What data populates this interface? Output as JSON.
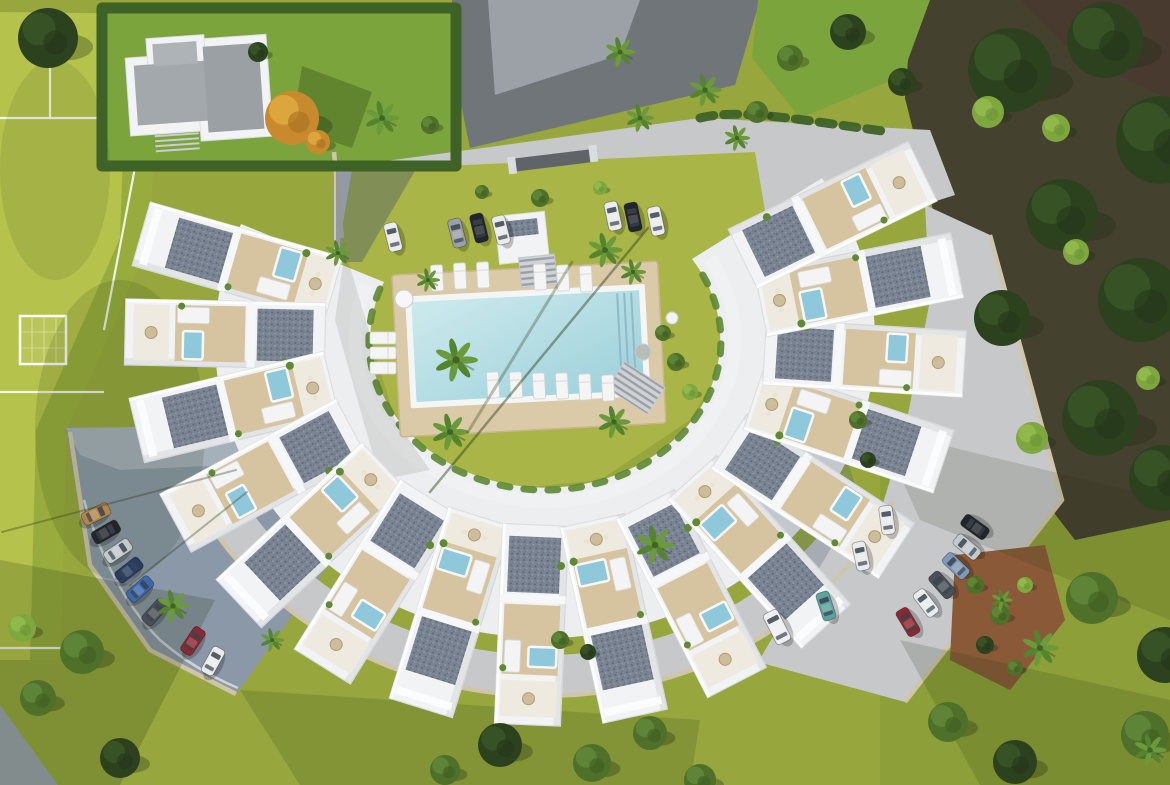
{
  "palette": {
    "grass": "#97a73e",
    "field": "#b5c24c",
    "fieldDark": "#93a83c",
    "lawnBright": "#7ba43c",
    "lawnCourt": "#a9b547",
    "hedge": "#3f6226",
    "road": "#70757a",
    "roadLight": "#9ba1a7",
    "pave": "#c6c8ca",
    "lot": "#8b98a8",
    "lotLight": "#a9b2bc",
    "building": "#f2f3f5",
    "buildingEdge": "#dcdfe2",
    "deck": "#d6c4a1",
    "poolDeck": "#dbcaa8",
    "poolRim": "#f4f6f6",
    "water1": "#cdeaed",
    "water2": "#9cd0da",
    "jacuzzi": "#8ec8da",
    "wall": "#cfc5ad",
    "soil": "#8a5a38",
    "roofGray": "#a3a8ac",
    "forest": "#45412f",
    "forestBrown": "#4a3a30",
    "olive": "#8d9f38",
    "paveShade": "#46566b"
  },
  "scene": {
    "buildings": {
      "cx": 545,
      "cy": 340,
      "rx": 320,
      "ry": 285,
      "len": 200,
      "wid": 66,
      "angles": [
        196,
        181.2,
        166.4,
        151.6,
        136.8,
        122,
        107.2,
        92.4,
        77.6,
        62.8,
        48,
        33.2,
        18.4,
        3.6,
        -11.2,
        -26
      ]
    },
    "cars": [
      {
        "x": 393,
        "y": 237,
        "rot": -14,
        "c": "#e9ebed"
      },
      {
        "x": 457,
        "y": 233,
        "rot": -14,
        "c": "#9aa1a8"
      },
      {
        "x": 479,
        "y": 228,
        "rot": -14,
        "c": "#22262b"
      },
      {
        "x": 501,
        "y": 230,
        "rot": -14,
        "c": "#e9ebed"
      },
      {
        "x": 613,
        "y": 216,
        "rot": -12,
        "c": "#e9ebed"
      },
      {
        "x": 633,
        "y": 217,
        "rot": -12,
        "c": "#22262b"
      },
      {
        "x": 656,
        "y": 221,
        "rot": -12,
        "c": "#e9ebed"
      },
      {
        "x": 96,
        "y": 514,
        "rot": 64,
        "c": "#b3854c"
      },
      {
        "x": 106,
        "y": 532,
        "rot": 60,
        "c": "#22262b"
      },
      {
        "x": 118,
        "y": 551,
        "rot": 56,
        "c": "#c4c9ce"
      },
      {
        "x": 129,
        "y": 570,
        "rot": 52,
        "c": "#273c63"
      },
      {
        "x": 140,
        "y": 589,
        "rot": 48,
        "c": "#3c69ac"
      },
      {
        "x": 155,
        "y": 612,
        "rot": 42,
        "c": "#4a5058"
      },
      {
        "x": 193,
        "y": 641,
        "rot": 34,
        "c": "#8d2731"
      },
      {
        "x": 213,
        "y": 661,
        "rot": 29,
        "c": "#e9ebed"
      },
      {
        "x": 975,
        "y": 527,
        "rot": -54,
        "c": "#22262b"
      },
      {
        "x": 967,
        "y": 547,
        "rot": -50,
        "c": "#c4c9ce"
      },
      {
        "x": 956,
        "y": 566,
        "rot": -46,
        "c": "#7f99b8"
      },
      {
        "x": 942,
        "y": 585,
        "rot": -42,
        "c": "#4a5058"
      },
      {
        "x": 926,
        "y": 603,
        "rot": -37,
        "c": "#e9ebed"
      },
      {
        "x": 908,
        "y": 622,
        "rot": -31,
        "c": "#8d2731"
      },
      {
        "x": 887,
        "y": 520,
        "rot": -8,
        "c": "#e9ebed"
      },
      {
        "x": 861,
        "y": 556,
        "rot": -12,
        "c": "#e9ebed"
      },
      {
        "x": 826,
        "y": 606,
        "rot": -18,
        "c": "#5ba39b"
      },
      {
        "x": 777,
        "y": 627,
        "rot": -27,
        "c": "#eef0f2",
        "van": true
      }
    ],
    "trees": [
      {
        "x": 1010,
        "y": 70,
        "r": 42,
        "t": "dark"
      },
      {
        "x": 1105,
        "y": 40,
        "r": 38,
        "t": "dark"
      },
      {
        "x": 1160,
        "y": 140,
        "r": 44,
        "t": "dark"
      },
      {
        "x": 1062,
        "y": 215,
        "r": 36,
        "t": "dark"
      },
      {
        "x": 1140,
        "y": 300,
        "r": 42,
        "t": "dark"
      },
      {
        "x": 1002,
        "y": 318,
        "r": 28,
        "t": "dark"
      },
      {
        "x": 1100,
        "y": 418,
        "r": 38,
        "t": "dark"
      },
      {
        "x": 1162,
        "y": 478,
        "r": 33,
        "t": "dark"
      },
      {
        "x": 988,
        "y": 112,
        "r": 16,
        "t": "light"
      },
      {
        "x": 1076,
        "y": 252,
        "r": 13,
        "t": "light"
      },
      {
        "x": 1032,
        "y": 438,
        "r": 16,
        "t": "light"
      },
      {
        "x": 1148,
        "y": 378,
        "r": 12,
        "t": "light"
      },
      {
        "x": 1056,
        "y": 128,
        "r": 14,
        "t": "light"
      },
      {
        "x": 1092,
        "y": 598,
        "r": 26,
        "t": "mid"
      },
      {
        "x": 1165,
        "y": 655,
        "r": 28,
        "t": "dark"
      },
      {
        "x": 1145,
        "y": 735,
        "r": 24,
        "t": "mid"
      },
      {
        "x": 948,
        "y": 722,
        "r": 20,
        "t": "mid"
      },
      {
        "x": 1015,
        "y": 762,
        "r": 22,
        "t": "dark"
      },
      {
        "x": 848,
        "y": 32,
        "r": 18,
        "t": "dark"
      },
      {
        "x": 902,
        "y": 82,
        "r": 14,
        "t": "dark"
      },
      {
        "x": 790,
        "y": 58,
        "r": 13,
        "t": "mid"
      },
      {
        "x": 757,
        "y": 112,
        "r": 11,
        "t": "mid"
      },
      {
        "x": 48,
        "y": 38,
        "r": 30,
        "t": "dark"
      },
      {
        "x": 292,
        "y": 118,
        "r": 27,
        "t": "orange"
      },
      {
        "x": 318,
        "y": 142,
        "r": 12,
        "t": "orange"
      },
      {
        "x": 258,
        "y": 52,
        "r": 10,
        "t": "dark"
      },
      {
        "x": 430,
        "y": 125,
        "r": 9,
        "t": "mid"
      },
      {
        "x": 82,
        "y": 652,
        "r": 22,
        "t": "mid"
      },
      {
        "x": 38,
        "y": 698,
        "r": 18,
        "t": "mid"
      },
      {
        "x": 120,
        "y": 758,
        "r": 20,
        "t": "dark"
      },
      {
        "x": 22,
        "y": 628,
        "r": 14,
        "t": "light"
      },
      {
        "x": 500,
        "y": 745,
        "r": 22,
        "t": "dark"
      },
      {
        "x": 592,
        "y": 763,
        "r": 19,
        "t": "mid"
      },
      {
        "x": 650,
        "y": 733,
        "r": 17,
        "t": "mid"
      },
      {
        "x": 445,
        "y": 770,
        "r": 15,
        "t": "mid"
      },
      {
        "x": 700,
        "y": 780,
        "r": 16,
        "t": "mid"
      },
      {
        "x": 975,
        "y": 585,
        "r": 9,
        "t": "mid"
      },
      {
        "x": 1000,
        "y": 615,
        "r": 10,
        "t": "mid"
      },
      {
        "x": 1025,
        "y": 585,
        "r": 8,
        "t": "light"
      },
      {
        "x": 985,
        "y": 645,
        "r": 9,
        "t": "dark"
      },
      {
        "x": 1015,
        "y": 668,
        "r": 8,
        "t": "mid"
      },
      {
        "x": 663,
        "y": 333,
        "r": 8,
        "t": "mid"
      },
      {
        "x": 676,
        "y": 362,
        "r": 9,
        "t": "mid"
      },
      {
        "x": 690,
        "y": 392,
        "r": 8,
        "t": "light"
      },
      {
        "x": 540,
        "y": 198,
        "r": 9,
        "t": "mid"
      },
      {
        "x": 600,
        "y": 188,
        "r": 7,
        "t": "light"
      },
      {
        "x": 482,
        "y": 192,
        "r": 7,
        "t": "mid"
      },
      {
        "x": 560,
        "y": 640,
        "r": 9,
        "t": "mid"
      },
      {
        "x": 588,
        "y": 652,
        "r": 8,
        "t": "dark"
      },
      {
        "x": 858,
        "y": 420,
        "r": 9,
        "t": "mid"
      },
      {
        "x": 868,
        "y": 460,
        "r": 8,
        "t": "dark"
      }
    ],
    "palms": [
      {
        "x": 382,
        "y": 118,
        "r": 16
      },
      {
        "x": 620,
        "y": 52,
        "r": 14
      },
      {
        "x": 640,
        "y": 118,
        "r": 13
      },
      {
        "x": 705,
        "y": 90,
        "r": 15
      },
      {
        "x": 737,
        "y": 138,
        "r": 12
      },
      {
        "x": 456,
        "y": 360,
        "r": 20
      },
      {
        "x": 450,
        "y": 432,
        "r": 17
      },
      {
        "x": 614,
        "y": 422,
        "r": 15
      },
      {
        "x": 655,
        "y": 545,
        "r": 18
      },
      {
        "x": 338,
        "y": 253,
        "r": 12
      },
      {
        "x": 428,
        "y": 280,
        "r": 11
      },
      {
        "x": 605,
        "y": 250,
        "r": 16
      },
      {
        "x": 633,
        "y": 272,
        "r": 12
      },
      {
        "x": 173,
        "y": 606,
        "r": 15
      },
      {
        "x": 1040,
        "y": 648,
        "r": 17
      },
      {
        "x": 1002,
        "y": 600,
        "r": 10
      },
      {
        "x": 272,
        "y": 640,
        "r": 11
      },
      {
        "x": 1150,
        "y": 750,
        "r": 15
      }
    ],
    "loungers": [
      {
        "x": 437,
        "y": 278,
        "rot": -3
      },
      {
        "x": 460,
        "y": 276,
        "rot": -3
      },
      {
        "x": 483,
        "y": 275,
        "rot": -3
      },
      {
        "x": 540,
        "y": 277,
        "rot": -3
      },
      {
        "x": 563,
        "y": 278,
        "rot": -3
      },
      {
        "x": 586,
        "y": 279,
        "rot": -3
      },
      {
        "x": 493,
        "y": 385,
        "rot": -3
      },
      {
        "x": 516,
        "y": 385,
        "rot": -3
      },
      {
        "x": 539,
        "y": 386,
        "rot": -3
      },
      {
        "x": 562,
        "y": 386,
        "rot": -3
      },
      {
        "x": 585,
        "y": 387,
        "rot": -3
      },
      {
        "x": 608,
        "y": 388,
        "rot": -3
      },
      {
        "x": 383,
        "y": 338,
        "rot": 90
      },
      {
        "x": 383,
        "y": 353,
        "rot": 90
      },
      {
        "x": 383,
        "y": 368,
        "rot": 90
      }
    ],
    "tables": [
      {
        "x": 404,
        "y": 299,
        "r": 9,
        "c": "#f6f7f6"
      },
      {
        "x": 672,
        "y": 318,
        "r": 6,
        "c": "#f2f3f2"
      },
      {
        "x": 643,
        "y": 352,
        "r": 8,
        "c": "#b9bdb9"
      }
    ],
    "pole_shadows": [
      {
        "x1": 648,
        "y1": 228,
        "x2": 430,
        "y2": 492,
        "w": 2.5,
        "o": 0.45
      },
      {
        "x1": 572,
        "y1": 262,
        "x2": 468,
        "y2": 432,
        "w": 3,
        "o": 0.3
      },
      {
        "x1": 247,
        "y1": 492,
        "x2": 130,
        "y2": 585,
        "w": 2,
        "o": 0.35
      },
      {
        "x1": 2,
        "y1": 532,
        "x2": 236,
        "y2": 470,
        "w": 2,
        "o": 0.35
      }
    ]
  }
}
